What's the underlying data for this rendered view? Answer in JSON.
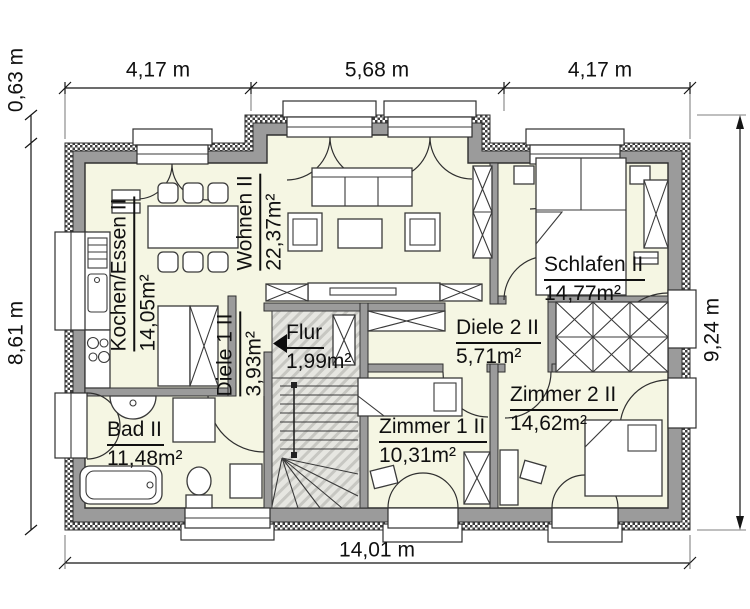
{
  "dims": {
    "top": [
      "4,17 m",
      "5,68 m",
      "4,17 m"
    ],
    "offset_top_left": "0,63 m",
    "left": "8,61 m",
    "right": "9,24 m",
    "bottom": "14,01 m"
  },
  "rooms": {
    "kochen_essen": {
      "name": "Kochen/Essen II",
      "area": "14,05m²"
    },
    "wohnen": {
      "name": "Wohnen II",
      "area": "22,37m²"
    },
    "schlafen": {
      "name": "Schlafen II",
      "area": "14,77m²"
    },
    "diele1": {
      "name": "Diele 1 II",
      "area": "3,93m²"
    },
    "flur": {
      "name": "Flur",
      "area": "1,99m²"
    },
    "diele2": {
      "name": "Diele 2 II",
      "area": "5,71m²"
    },
    "zimmer1": {
      "name": "Zimmer 1 II",
      "area": "10,31m²"
    },
    "zimmer2": {
      "name": "Zimmer 2 II",
      "area": "14,62m²"
    },
    "bad": {
      "name": "Bad II",
      "area": "11,48m²"
    }
  },
  "colors": {
    "floor": "#f5f6e3",
    "wall": "#9b9b9b",
    "hatch": "#d9d9d4",
    "line": "#151515"
  }
}
